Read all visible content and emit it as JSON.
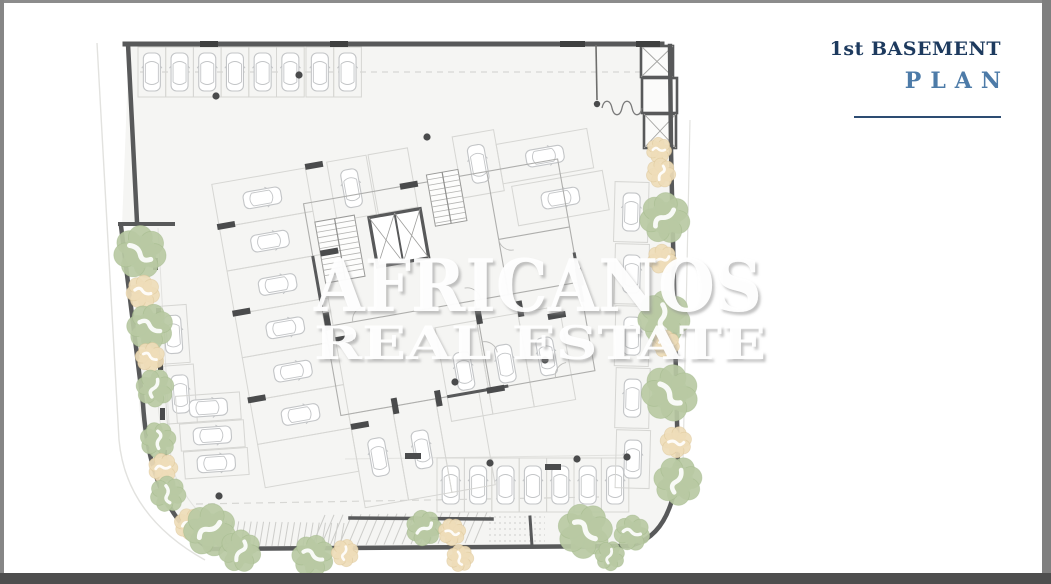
{
  "title_block": {
    "line1": "1st BASEMENT",
    "line2": "PLAN",
    "line1_color": "#1d3a5e",
    "line2_color": "#4d7ba8",
    "rule_color": "#2d4c72"
  },
  "watermark": {
    "line1": "AFRICANOS",
    "line2": "REAL ESTATE"
  },
  "frame": {
    "top": "#8c8c8c",
    "left": "#868686",
    "right": "#7f7f7f",
    "bottom": "#4e4e4e"
  },
  "plan": {
    "colors": {
      "floor": "#f5f5f3",
      "wall": "#58595a",
      "wall_dark": "#3f4040",
      "thin": "#d7d7d4",
      "faint": "#e2e2df",
      "partition": "#aeaeac",
      "car": "#c3c5c7",
      "stall": "#d6d6d3",
      "dot": "#4a4b4c",
      "tree_green_fill": "#b8c9a3",
      "tree_green_edge": "#9eb585",
      "tree_tan_fill": "#eedcb8",
      "tree_tan_edge": "#d9c291",
      "hatch": "#cdcdca",
      "ramp_sym": "#7a7a7a"
    },
    "floor_path": "M129,45 H666 L673,113 L678,465 Q671,541 626,548 L212,550 Q147,511 139,403 L133,226 L122,226 Z",
    "walls": [
      {
        "d": "M125,44 L662,44",
        "w": 5
      },
      {
        "d": "M128,44 L137,222",
        "w": 4.5
      },
      {
        "d": "M120,224 L173,224",
        "w": 4
      },
      {
        "d": "M121,226 L143,404 Q150,512 210,549",
        "w": 4.5
      },
      {
        "d": "M208,549 L628,546",
        "w": 4.5
      },
      {
        "d": "M628,546 Q672,538 678,466",
        "w": 4.5
      },
      {
        "d": "M678,466 L671,150 L670,46",
        "w": 4.5
      },
      {
        "d": "M350,518 L492,519",
        "w": 3.5
      },
      {
        "d": "M530,517 L532,546",
        "w": 3
      }
    ],
    "wall_ticks": [
      {
        "d": "M200,44 L218,44",
        "w": 6
      },
      {
        "d": "M330,44 L348,44",
        "w": 6
      },
      {
        "d": "M560,44 L585,44",
        "w": 6
      },
      {
        "d": "M636,44 L660,44",
        "w": 6
      }
    ],
    "faint_lines": [
      {
        "d": "M97,43 L119,440 Q126,516 205,560",
        "w": 1.4
      },
      {
        "d": "M690,120 L683,462",
        "w": 1.2
      },
      {
        "d": "M158,404 Q166,494 220,530",
        "w": 1
      },
      {
        "d": "M158,228 L172,478",
        "w": 1
      },
      {
        "d": "M345,459 L632,455",
        "w": 1
      }
    ],
    "dashed_lines": [
      {
        "d": "M140,72 H656",
        "dash": "6 5"
      },
      {
        "d": "M196,504 L600,497",
        "dash": "7 5"
      },
      {
        "d": "M489,517 H545 M489,523 H545 M489,529 H545 M489,535 H545 M489,541 H545",
        "dash": "2 3"
      }
    ],
    "rooms_tr": [
      {
        "x": 641,
        "y": 46,
        "w": 32,
        "h": 31,
        "cross": true
      },
      {
        "x": 642,
        "y": 78,
        "w": 35,
        "h": 35,
        "cross": false
      },
      {
        "x": 644,
        "y": 114,
        "w": 32,
        "h": 34,
        "cross": true
      }
    ],
    "ramp_symbol": {
      "line": "M596,45 L597,100",
      "dot": [
        597,
        104,
        3.2
      ],
      "bumps": "M602,108 c2,-9 8,-9 10,0 c2,9 8,9 10,0 c2,-9 8,-9 10,0 c2,9 8,9 10,0"
    },
    "hatch_rails": [
      {
        "x0": 214,
        "y0": 521,
        "x1": 344,
        "y1": 523,
        "dx": -4,
        "dy": 24,
        "n": 22
      },
      {
        "x0": 312,
        "y0": 546,
        "x1": 474,
        "y1": 543,
        "dx": 13,
        "dy": -31,
        "n": 19
      }
    ],
    "stall_groups": [
      {
        "name": "top-row",
        "transform": "",
        "stalls": [
          [
            138,
            47,
            27.7,
            50,
            "v"
          ],
          [
            165.7,
            47,
            27.7,
            50,
            "v"
          ],
          [
            193.4,
            47,
            27.7,
            50,
            "v"
          ],
          [
            221.1,
            47,
            27.7,
            50,
            "v"
          ],
          [
            248.8,
            47,
            27.7,
            50,
            "v"
          ],
          [
            276.5,
            47,
            27.7,
            50,
            "v"
          ],
          [
            306,
            47,
            27.7,
            50,
            "v"
          ],
          [
            333.7,
            47,
            27.7,
            50,
            "v"
          ]
        ]
      },
      {
        "name": "bottom-row",
        "transform": "",
        "stalls": [
          [
            437,
            458,
            27.4,
            54,
            "v"
          ],
          [
            464.4,
            458,
            27.4,
            54,
            "v"
          ],
          [
            491.8,
            458,
            27.4,
            54,
            "v"
          ],
          [
            519.2,
            458,
            27.4,
            54,
            "v"
          ],
          [
            546.6,
            458,
            27.4,
            54,
            "v"
          ],
          [
            574,
            458,
            27.4,
            54,
            "v"
          ],
          [
            601.4,
            458,
            27.4,
            54,
            "v"
          ]
        ]
      },
      {
        "name": "right-wall-column",
        "transform": "rotate(1.5 630 300)",
        "stalls": [
          [
            612,
            182,
            34,
            60,
            "v"
          ],
          [
            614,
            244,
            34,
            60,
            "v"
          ],
          [
            616,
            306,
            34,
            60,
            "v"
          ],
          [
            618,
            368,
            34,
            60,
            "v"
          ],
          [
            620,
            430,
            34,
            58,
            "v"
          ]
        ]
      },
      {
        "name": "left-wall-group",
        "transform": "rotate(-4 180 360)",
        "stalls": [
          [
            160,
            305,
            30,
            58,
            "v"
          ],
          [
            163,
            365,
            30,
            58,
            "v"
          ],
          [
            173,
            396,
            64,
            27,
            "h"
          ],
          [
            175,
            424,
            64,
            27,
            "h"
          ],
          [
            177,
            452,
            64,
            27,
            "h"
          ]
        ]
      },
      {
        "name": "interior-rotated",
        "transform": "rotate(-10 420 300)",
        "stalls": [
          [
            352,
            148,
            40,
            60,
            "v"
          ],
          [
            394,
            148,
            40,
            60,
            ""
          ],
          [
            480,
            145,
            42,
            62,
            "v"
          ],
          [
            522,
            160,
            92,
            40,
            "h"
          ],
          [
            530,
            204,
            92,
            40,
            "h"
          ],
          [
            235,
            150,
            95,
            44,
            "h"
          ],
          [
            235,
            194,
            95,
            44,
            "h"
          ],
          [
            235,
            238,
            95,
            44,
            "h"
          ],
          [
            235,
            282,
            95,
            44,
            "h"
          ],
          [
            235,
            326,
            95,
            44,
            "h"
          ],
          [
            235,
            370,
            95,
            44,
            "h"
          ],
          [
            235,
            414,
            95,
            44,
            ""
          ],
          [
            430,
            330,
            42,
            95,
            "v"
          ],
          [
            472,
            330,
            42,
            95,
            "v"
          ],
          [
            514,
            330,
            42,
            95,
            "v"
          ],
          [
            330,
            400,
            44,
            95,
            "v"
          ],
          [
            374,
            400,
            44,
            95,
            "v"
          ],
          [
            418,
            400,
            44,
            95,
            ""
          ]
        ]
      }
    ],
    "core": {
      "transform": "rotate(-10 420 300)",
      "elevator": {
        "x": 384,
        "y": 210,
        "w": 52,
        "h": 50
      },
      "stairs": [
        {
          "x": 330,
          "y": 205,
          "w": 40,
          "h": 62
        },
        {
          "x": 448,
          "y": 178,
          "w": 32,
          "h": 52
        }
      ],
      "partitions": "M322,185 H580 V400 H322 Z M322,310 H580 M474,310 V400 M508,185 V310 M508,254 H580",
      "dark_segs": "M322,238 V290 M580,280 V330 M430,400 H492",
      "arcs": "M350,310 a13,13 0 0 1 13,-13 M480,310 a14,14 0 0 0 -14,-14 M474,352 a13,13 0 0 1 13,13 M508,254 a13,13 0 0 0 13,13 M540,400 a13,13 0 0 1 13,-13",
      "piers": [
        [
          330,
          146,
          18,
          6
        ],
        [
          330,
          234,
          18,
          6
        ],
        [
          330,
          322,
          18,
          6
        ],
        [
          330,
          410,
          18,
          6
        ],
        [
          233,
          190,
          18,
          6
        ],
        [
          233,
          278,
          18,
          6
        ],
        [
          233,
          366,
          18,
          6
        ],
        [
          420,
          182,
          18,
          6
        ],
        [
          470,
          398,
          18,
          6
        ],
        [
          322,
          296,
          6,
          18
        ],
        [
          578,
          296,
          6,
          18
        ],
        [
          472,
          318,
          6,
          16
        ],
        [
          514,
          318,
          6,
          16
        ],
        [
          374,
          392,
          6,
          16
        ],
        [
          418,
          392,
          6,
          16
        ],
        [
          543,
          336,
          18,
          6
        ]
      ]
    },
    "piers": [
      [
        153,
        258,
        5,
        12
      ],
      [
        156,
        308,
        5,
        12
      ],
      [
        158,
        358,
        5,
        12
      ],
      [
        160,
        408,
        5,
        12
      ],
      [
        162,
        450,
        5,
        12
      ],
      [
        405,
        453,
        16,
        6
      ],
      [
        545,
        464,
        16,
        6
      ]
    ],
    "dots": [
      [
        216,
        96
      ],
      [
        299,
        75
      ],
      [
        427,
        137
      ],
      [
        219,
        496
      ],
      [
        455,
        382
      ],
      [
        545,
        360
      ],
      [
        490,
        463
      ],
      [
        577,
        459
      ],
      [
        627,
        457
      ]
    ],
    "trees": [
      [
        140,
        252,
        25,
        "g"
      ],
      [
        143,
        292,
        16,
        "t"
      ],
      [
        150,
        327,
        22,
        "g"
      ],
      [
        150,
        357,
        14,
        "t"
      ],
      [
        155,
        388,
        18,
        "g"
      ],
      [
        158,
        440,
        17,
        "g"
      ],
      [
        163,
        468,
        14,
        "t"
      ],
      [
        168,
        494,
        17,
        "g"
      ],
      [
        190,
        524,
        15,
        "t"
      ],
      [
        210,
        530,
        25,
        "g"
      ],
      [
        240,
        551,
        20,
        "g"
      ],
      [
        313,
        556,
        20,
        "g"
      ],
      [
        345,
        553,
        13,
        "t"
      ],
      [
        424,
        528,
        17,
        "g"
      ],
      [
        452,
        532,
        13,
        "t"
      ],
      [
        460,
        558,
        13,
        "t"
      ],
      [
        585,
        531,
        26,
        "g"
      ],
      [
        632,
        533,
        17,
        "g"
      ],
      [
        610,
        556,
        14,
        "g"
      ],
      [
        659,
        150,
        12,
        "t"
      ],
      [
        661,
        173,
        14,
        "t"
      ],
      [
        665,
        218,
        24,
        "g"
      ],
      [
        662,
        259,
        14,
        "t"
      ],
      [
        664,
        317,
        25,
        "g"
      ],
      [
        666,
        344,
        13,
        "t"
      ],
      [
        670,
        393,
        27,
        "g"
      ],
      [
        676,
        442,
        15,
        "t"
      ],
      [
        678,
        481,
        23,
        "g"
      ]
    ]
  }
}
